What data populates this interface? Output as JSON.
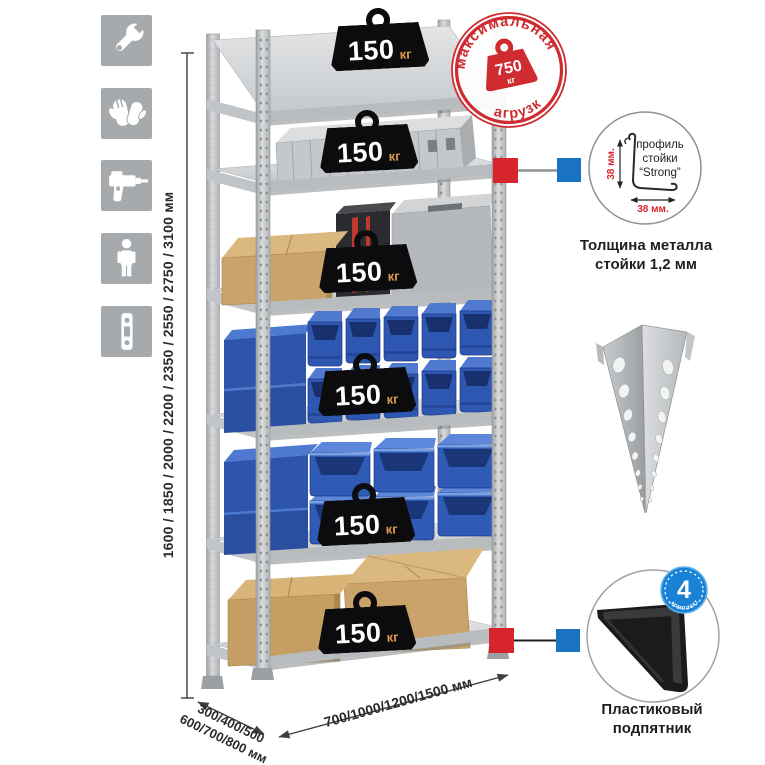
{
  "stamp": {
    "arc_top": "максимальная",
    "arc_bottom": "нагрузка",
    "weight": "750",
    "weight_unit": "кг"
  },
  "shelf_badges": [
    {
      "value": "150",
      "unit": "кг"
    },
    {
      "value": "150",
      "unit": "кг"
    },
    {
      "value": "150",
      "unit": "кг"
    },
    {
      "value": "150",
      "unit": "кг"
    },
    {
      "value": "150",
      "unit": "кг"
    },
    {
      "value": "150",
      "unit": "кг"
    }
  ],
  "dimensions": {
    "height_label": "1600 / 1850 / 2000 / 2200 / 2350 / 2550 / 2750 / 3100 мм",
    "depth_label_line1": "300/400/500",
    "depth_label_line2": "600/700/800 мм",
    "width_label": "700/1000/1200/1500 мм"
  },
  "profile_detail": {
    "line1": "профиль",
    "line2": "стойки",
    "line3": "“Strong”",
    "vertical_dim": "38 мм.",
    "horizontal_dim": "38 мм.",
    "caption_line1": "Толщина металла",
    "caption_line2": "стойки 1,2 мм"
  },
  "foot_detail": {
    "count": "4",
    "count_caption": "в комплекте",
    "caption_line1": "Пластиковый",
    "caption_line2": "подпятник"
  },
  "sidebar_icons": [
    "wrench",
    "gloves",
    "drill",
    "person",
    "perforated-strip"
  ],
  "colors": {
    "stamp_red": "#cf2b30",
    "connector_red": "#d6252b",
    "connector_blue": "#1a72c2",
    "bin_blue": "#2e57b2",
    "metal_gray": "#c8cacc",
    "icon_bg": "#a7aaac"
  }
}
